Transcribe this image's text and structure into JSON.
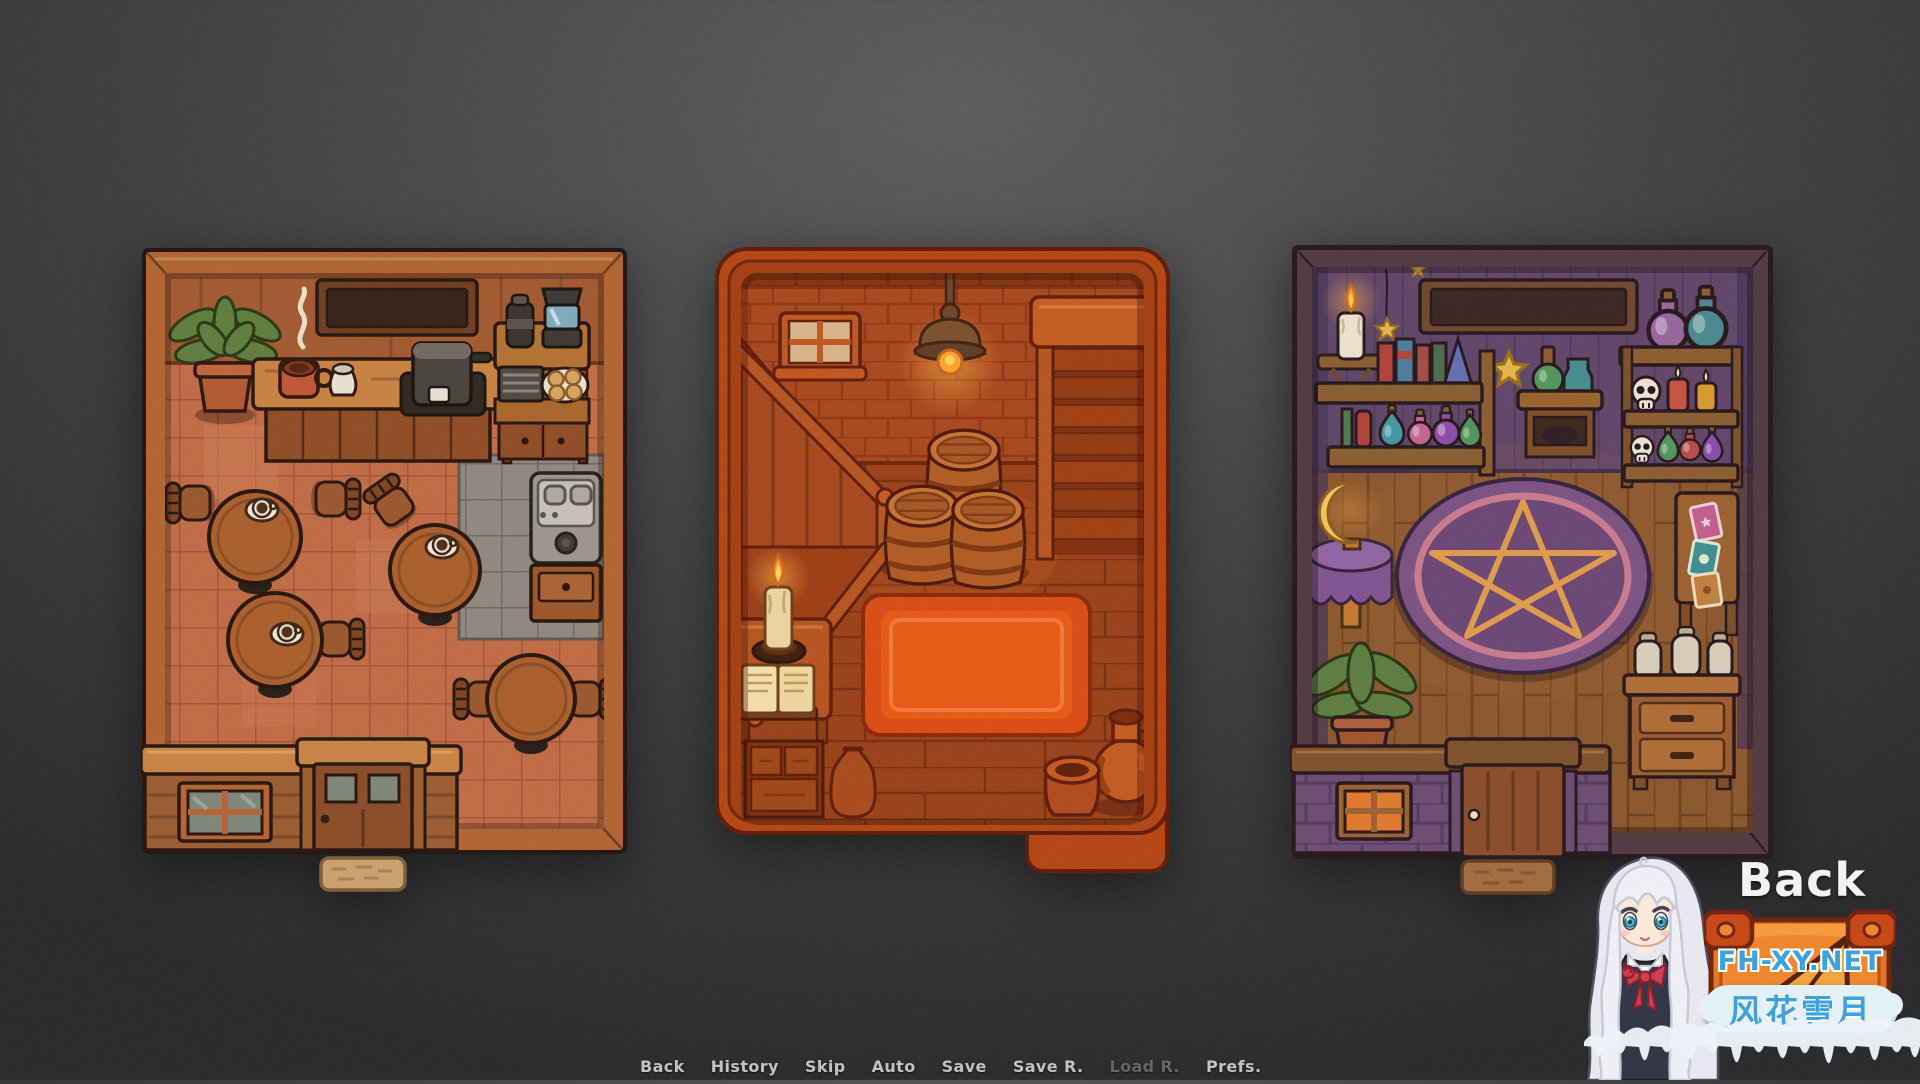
{
  "screen": {
    "width": 1920,
    "height": 1080,
    "kind": "visual-novel location select"
  },
  "map_select": {
    "rooms": [
      {
        "id": "cafe",
        "name": "cafe-interior-thumbnail",
        "description": "top-down cafe room with counter, coffee machine, round tables with coffee cups, plant, kitchen corner, facade with door and windows"
      },
      {
        "id": "cellar",
        "name": "cellar-interior-thumbnail",
        "description": "top-down dim cellar with staircases, hanging lamp, stacked barrels, red rug, desk with candle and open book, clay jug and pot"
      },
      {
        "id": "witch_shop",
        "name": "witch-shop-interior-thumbnail",
        "description": "top-down witch shop with potion shelves, skulls, candles, pentagram rug, moon lamp table, tarot desk, plant, purple facade with door and glowing window"
      }
    ]
  },
  "watermark": {
    "back_label": "Back",
    "site_name": "FH-XY.NET",
    "site_name_cn": "风花雪月",
    "mascot": "anime-girl-white-hair",
    "badge": "orange-suitcase-logo"
  },
  "quick_menu": {
    "items": [
      {
        "label": "Back",
        "enabled": true
      },
      {
        "label": "History",
        "enabled": true
      },
      {
        "label": "Skip",
        "enabled": true
      },
      {
        "label": "Auto",
        "enabled": true
      },
      {
        "label": "Save",
        "enabled": true
      },
      {
        "label": "Save R.",
        "enabled": true
      },
      {
        "label": "Load R.",
        "enabled": false
      },
      {
        "label": "Prefs.",
        "enabled": true
      }
    ]
  },
  "palette": {
    "bgCenter": "#5a5a5c",
    "bgMid": "#3d3d3f",
    "bgEdge": "#262628",
    "menuText": "#c3c3c3",
    "menuDisabled": "#616161",
    "wmBlue": "#38a0e0",
    "wmBack": "#f5f5f5",
    "cafeFrame": "#b2622f",
    "cafeFloor": "#c06a42",
    "cellarFrame": "#b5430f",
    "cellarRug": "#e8580f",
    "witchFrame": "#4e3840",
    "witchWall": "#5e4366",
    "pentagram": "#e09a48"
  }
}
